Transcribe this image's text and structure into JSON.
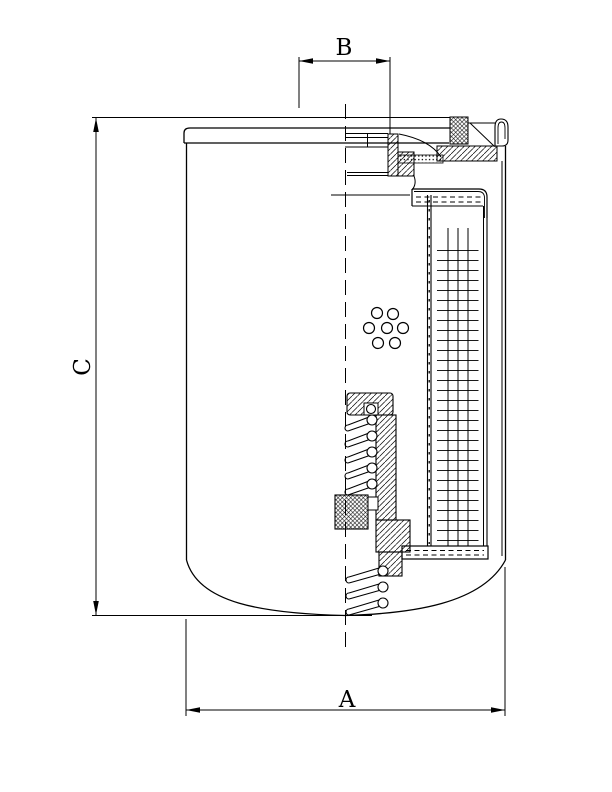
{
  "drawing": {
    "labels": {
      "a": "A",
      "b": "B",
      "c": "C"
    },
    "line_color": "#000000",
    "background_color": "#ffffff"
  }
}
